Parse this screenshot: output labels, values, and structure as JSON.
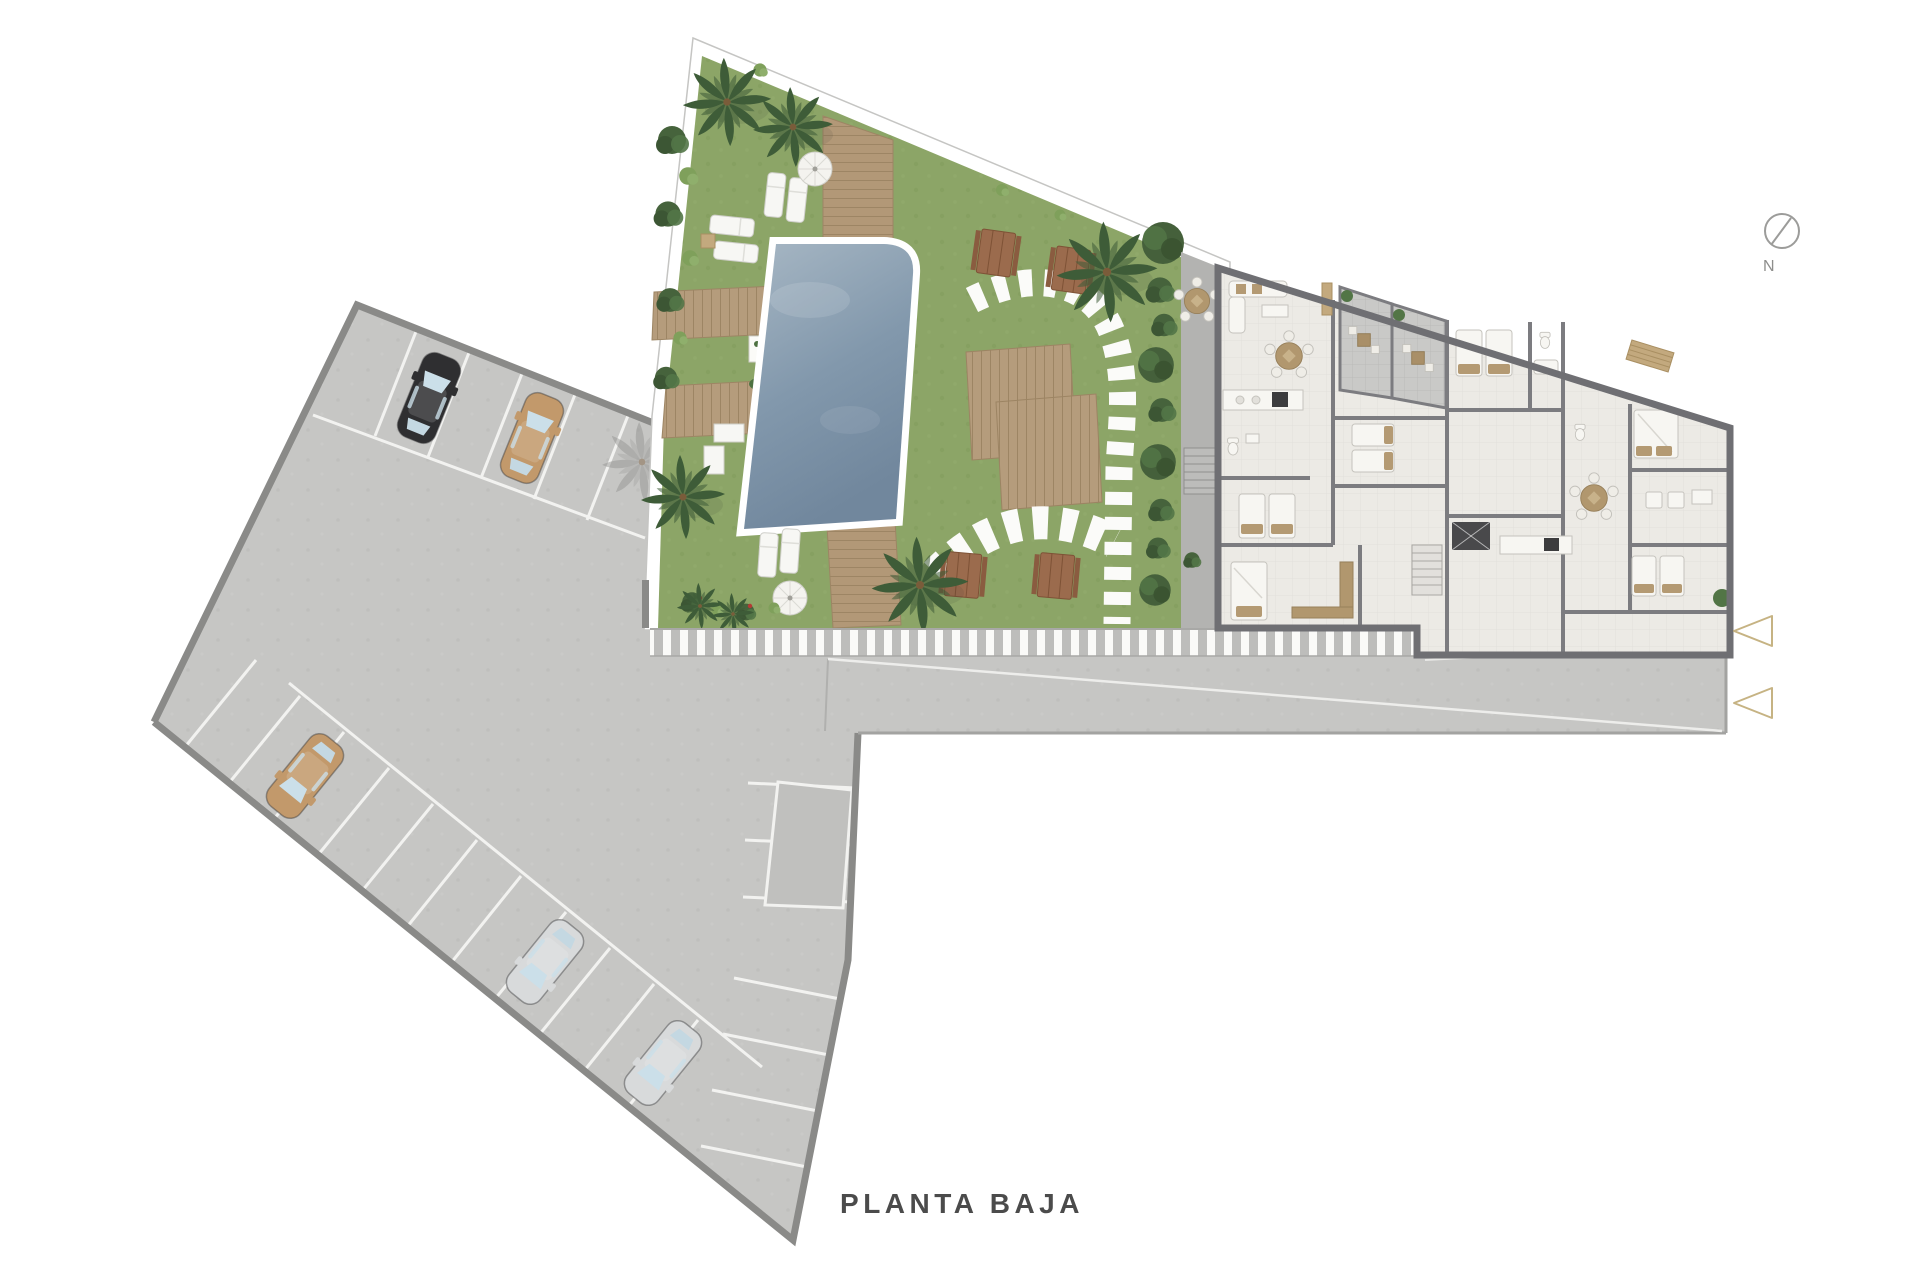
{
  "title": {
    "label": "PLANTA BAJA"
  },
  "compass": {
    "label": "N"
  },
  "palette": {
    "background": "#FFFFFF",
    "pavement": "#C6C6C4",
    "pavement_border": "#8A8A88",
    "marking_white": "#F2F2F0",
    "grass": "#8CA567",
    "hedge": "#46633C",
    "wood_deck": "#B59C7C",
    "picnic_wood": "#9B6B4D",
    "pool_water_light": "#A7B7C4",
    "pool_water_dark": "#71879D",
    "pool_rim": "#FFFFFF",
    "patio": "#B3B3B1",
    "building_floor": "#ECEAE5",
    "building_wall": "#6F6F73",
    "terrace": "#C9C9C7",
    "furniture_tan": "#B1976E",
    "bed_white": "#F7F6F2",
    "car_black": "#2F2F31",
    "car_tan": "#C2996B",
    "car_silver": "#D8DADB",
    "entrance_arrow": "#C6B383",
    "compass_gray": "#9C9C9A",
    "title_text": "#4B4B4B"
  },
  "parking": {
    "rows": 3,
    "has_reserved_space": true,
    "cars": [
      {
        "color_name": "black"
      },
      {
        "color_name": "tan"
      },
      {
        "color_name": "tan"
      },
      {
        "color_name": "silver"
      },
      {
        "color_name": "silver"
      }
    ]
  },
  "garden": {
    "features": [
      "swimming-pool",
      "palm-trees",
      "wood-decks",
      "sun-loungers",
      "parasols",
      "stepping-stone-path",
      "picnic-tables",
      "hedge",
      "planters"
    ]
  },
  "building": {
    "terraces": 2,
    "patio_tables": 1,
    "entrance_arrows": 2
  }
}
